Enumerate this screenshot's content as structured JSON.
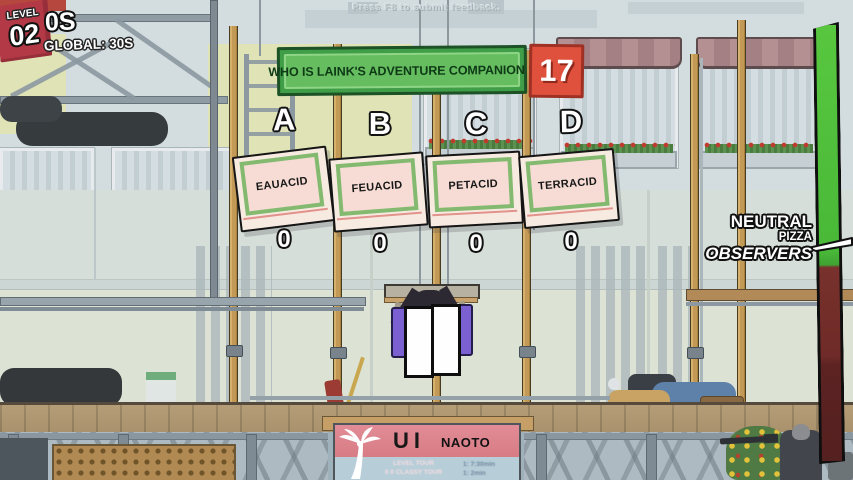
{
  "meta": {
    "feedback_hint": "Press F8 to submit feedback."
  },
  "hud": {
    "level_badge": {
      "label": "LEVEL",
      "value": "02"
    },
    "timer_self": "0S",
    "timer_global": "GLOBAL: 30S",
    "question": {
      "text": "WHO IS LAINK'S ADVENTURE COMPANION ?",
      "countdown": "17"
    },
    "answers": [
      {
        "letter": "A",
        "label": "EAUACID",
        "votes": "0"
      },
      {
        "letter": "B",
        "label": "FEUACID",
        "votes": "0"
      },
      {
        "letter": "C",
        "label": "PETACID",
        "votes": "0"
      },
      {
        "letter": "D",
        "label": "TERRACID",
        "votes": "0"
      }
    ],
    "crowd_gauge": {
      "label_line1": "NEUTRAL",
      "label_line2": "PIZZA",
      "label_line3": "OBSERVERS",
      "green_color": "#49b838",
      "red_color": "#6f2b28",
      "green_fill_percent": 55
    }
  },
  "billboard": {
    "title_left": "UI",
    "title_right": "NAOTO",
    "fine_print_left": [
      "LEVEL TOUR",
      "0 0 CLASSY TOUR"
    ],
    "fine_print_right": [
      "1: 7:30min",
      "1: 2min"
    ]
  },
  "colors": {
    "question_green": "#66bd60",
    "countdown_red": "#e0513d",
    "level_red": "#b23945",
    "pizza_box_pink": "#f6dcd4",
    "pizza_frame_green": "#83ba70",
    "placard_purple": "#7b60d1"
  }
}
